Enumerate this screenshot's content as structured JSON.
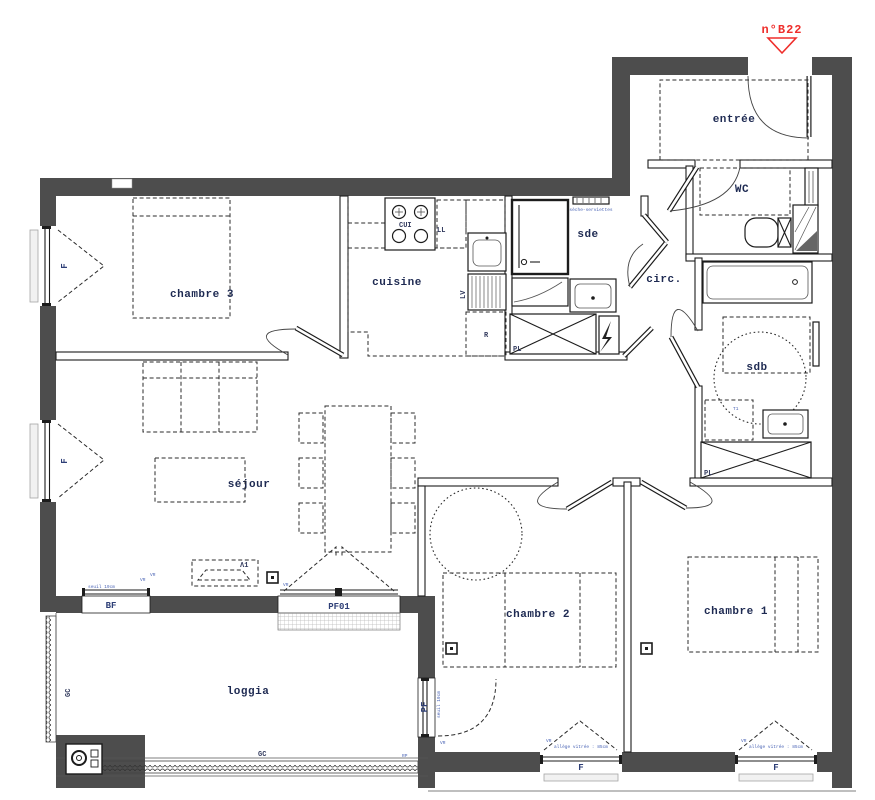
{
  "unit": {
    "label": "n°B22"
  },
  "rooms": {
    "entree": "entrée",
    "wc": "WC",
    "sde": "sde",
    "circ": "circ.",
    "sdb": "sdb",
    "chambre3": "chambre 3",
    "cuisine": "cuisine",
    "sejour": "séjour",
    "chambre2": "chambre 2",
    "chambre1": "chambre 1",
    "loggia": "loggia"
  },
  "equipment": {
    "cooktop": "CUI",
    "washer": "LL",
    "dishwasher": "LV",
    "fridge": "R",
    "closet": "PL",
    "radiator": "Λ1",
    "towel_rail": "sèche-serviettes",
    "tub_zone": "T1"
  },
  "openings": {
    "window": "F",
    "low_window": "BF",
    "french_window": "PF01",
    "door_window": "PF",
    "railing": "GC",
    "roller_shutter": "VR",
    "rp": "RP"
  },
  "notes": {
    "threshold": "seuil 19cm",
    "sill_height": "allège vitrée : 85cm"
  },
  "colors": {
    "wall": "#4d4d4d",
    "line": "#1c1c1c",
    "room_label": "#1e2a52",
    "tech_label": "#2e3f77",
    "annotation": "#4a64b5",
    "unit_label": "#ef2e2b"
  }
}
